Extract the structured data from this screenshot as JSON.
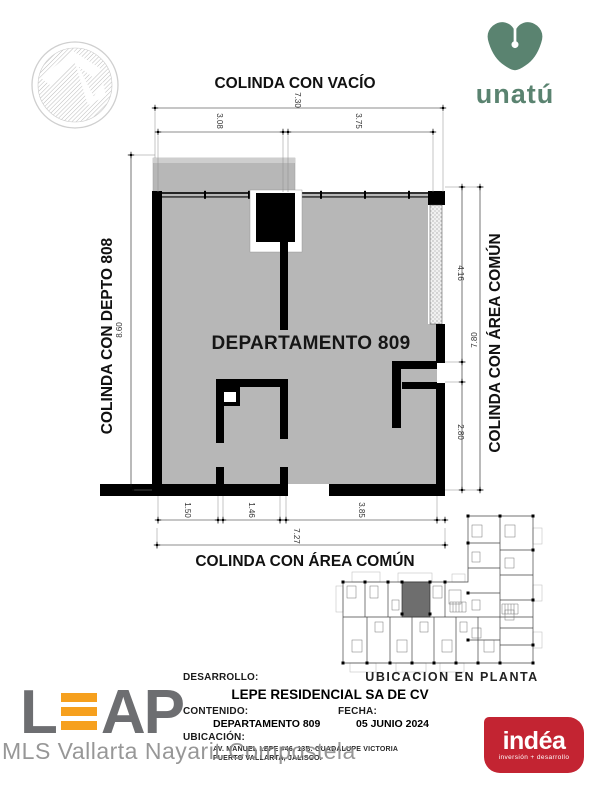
{
  "logos": {
    "architect_seal": "hatched-circle-mark",
    "unatu": {
      "name": "unatú",
      "color": "#5a8370"
    },
    "leap": {
      "l": "L",
      "a": "A",
      "p": "P",
      "gray": "#6d6e71",
      "orange": "#f6a01e"
    },
    "indea": {
      "name": "indéa",
      "tagline": "inversión + desarrollo",
      "color": "#c32432"
    },
    "watermark": "MLS Vallarta Nayarit Compostela"
  },
  "plan": {
    "unit_label": "DEPARTAMENTO 809",
    "adjacency": {
      "top": "COLINDA CON VACÍO",
      "left": "COLINDA CON DEPTO 808",
      "right": "COLINDA CON ÁREA COMÚN",
      "bottom": "COLINDA CON ÁREA COMÚN"
    },
    "dimensions": {
      "top_overall": "7.30",
      "top_left": "3.08",
      "top_right": "3.75",
      "left_overall": "8.60",
      "right_upper": "4.16",
      "right_overall": "7.80",
      "right_lower": "2.80",
      "bottom_1": "1.50",
      "bottom_2": "1.46",
      "bottom_3": "3.85",
      "bottom_overall": "7.27"
    },
    "fill_color": "#b7b7b7"
  },
  "miniplan": {
    "caption": "UBICACION EN PLANTA"
  },
  "titleblock": {
    "desarrollo_label": "DESARROLLO:",
    "desarrollo_value": "LEPE RESIDENCIAL SA DE CV",
    "contenido_label": "CONTENIDO:",
    "contenido_value": "DEPARTAMENTO 809",
    "fecha_label": "FECHA:",
    "fecha_value": "05 JUNIO 2024",
    "ubicacion_label": "UBICACIÓN:",
    "ubicacion_line1": "AV. MANUEL LEPE #46, 13B. GUADALUPE VICTORIA",
    "ubicacion_line2": "PUERTO VALLARTA, JALISCO."
  }
}
